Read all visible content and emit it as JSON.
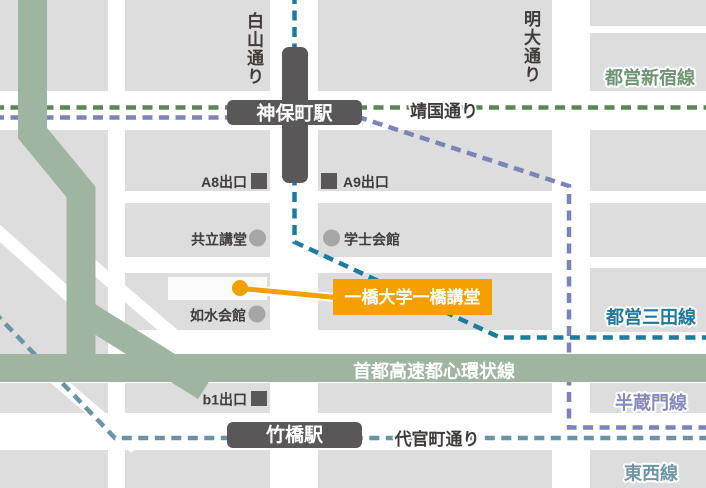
{
  "colors": {
    "orange": "#F6A000",
    "band": "#9FB4A1",
    "block": "#DCDDDC",
    "station": "#595757",
    "text": "#3F3B3A",
    "poiDot": "#A6A6A6",
    "highlightBuilding": "#FCFCFA",
    "shinjukuDash": "#5B8656",
    "mitaDash": "#1B7C9E",
    "hanzomonDash": "#7B84B8",
    "tozaiDash": "#6B93A6",
    "shinjukuLabel": "#6E9573",
    "mitaLabel": "#21789B",
    "hanzomonLabel": "#858ABB",
    "tozaiLabel": "#6F96A6"
  },
  "streets": {
    "hakusan": "白山通り",
    "meidai": "明大通り",
    "yasukuni": "靖国通り",
    "daikancho": "代官町通り",
    "expressway": "首都高速都心環状線"
  },
  "railLines": {
    "shinjuku": "都営新宿線",
    "mita": "都営三田線",
    "hanzomon": "半蔵門線",
    "tozai": "東西線"
  },
  "stations": {
    "jimbocho": "神保町駅",
    "takebashi": "竹橋駅"
  },
  "exits": {
    "a8": "A8出口",
    "a9": "A9出口",
    "b1": "b1出口"
  },
  "pois": {
    "kyoritsu": "共立講堂",
    "gakushi": "学士会館",
    "josui": "如水会館"
  },
  "destination": {
    "label": "一橋大学一橋講堂"
  }
}
